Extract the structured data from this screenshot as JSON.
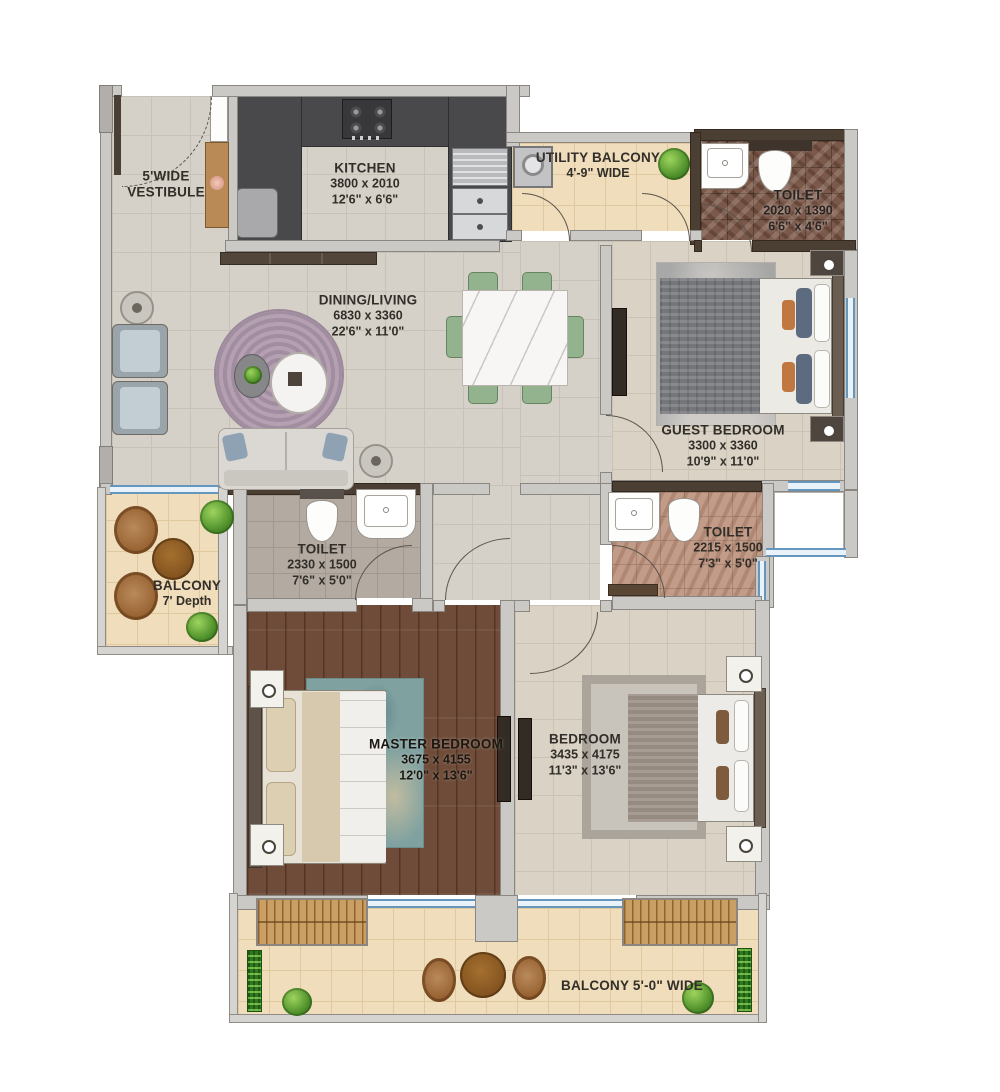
{
  "rooms": {
    "vestibule": {
      "line1": "5'WIDE",
      "line2": "VESTIBULE"
    },
    "kitchen": {
      "name": "KITCHEN",
      "dim_mm": "3800 x 2010",
      "dim_ft": "12'6\" x 6'6\""
    },
    "utility_balcony": {
      "name": "UTILITY BALCONY",
      "dim_ft": "4'-9\" WIDE"
    },
    "toilet_guest": {
      "name": "TOILET",
      "dim_mm": "2020 x 1390",
      "dim_ft": "6'6\" x 4'6\""
    },
    "dining_living": {
      "name": "DINING/LIVING",
      "dim_mm": "6830 x 3360",
      "dim_ft": "22'6\" x 11'0\""
    },
    "guest_bedroom": {
      "name": "GUEST BEDROOM",
      "dim_mm": "3300 x 3360",
      "dim_ft": "10'9\" x 11'0\""
    },
    "balcony_left": {
      "name": "BALCONY",
      "dim_ft": "7' Depth"
    },
    "toilet_master": {
      "name": "TOILET",
      "dim_mm": "2330 x 1500",
      "dim_ft": "7'6\" x 5'0\""
    },
    "toilet_common": {
      "name": "TOILET",
      "dim_mm": "2215 x 1500",
      "dim_ft": "7'3\" x 5'0\""
    },
    "master_bedroom": {
      "name": "MASTER BEDROOM",
      "dim_mm": "3675 x 4155",
      "dim_ft": "12'0\" x 13'6\""
    },
    "bedroom": {
      "name": "BEDROOM",
      "dim_mm": "3435 x 4175",
      "dim_ft": "11'3\" x 13'6\""
    },
    "balcony_bottom": {
      "name": "BALCONY 5'-0\" WIDE"
    }
  },
  "colors": {
    "wall": "#cbc9c5",
    "wall_dark": "#4b3e33",
    "window_blue": "#6596bd",
    "tile_floor": "#d6d1c8",
    "cream_floor": "#efddbb",
    "wood_floor": "#6f4c39",
    "toilet_marble": "#7b594a",
    "chair_green": "#93b28e",
    "rug_purple": "#b5a0b2",
    "text": "#322e29"
  }
}
